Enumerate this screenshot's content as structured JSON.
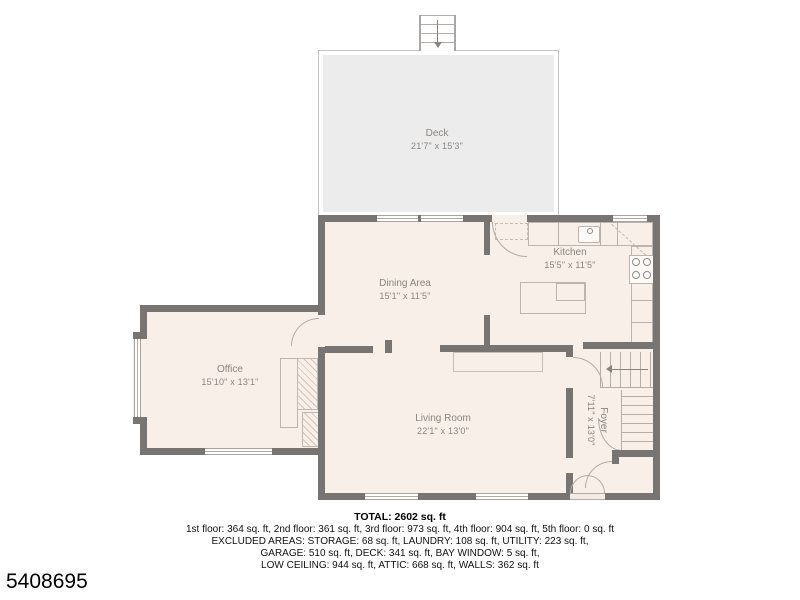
{
  "plan": {
    "watermark_id": "5408695",
    "rooms": {
      "deck": {
        "label": "Deck",
        "dims": "21'7\" x 15'3\""
      },
      "dining": {
        "label": "Dining Area",
        "dims": "15'1\" x 11'5\""
      },
      "kitchen": {
        "label": "Kitchen",
        "dims": "15'5\" x 11'5\""
      },
      "office": {
        "label": "Office",
        "dims": "15'10\" x 13'1\""
      },
      "living": {
        "label": "Living Room",
        "dims": "22'1\" x 13'0\""
      },
      "foyer": {
        "label": "Foyer",
        "dims": "7'11\" x 13'0\""
      }
    },
    "summary": {
      "total": "TOTAL: 2602 sq. ft",
      "line1": "1st floor: 364 sq. ft, 2nd floor: 361 sq. ft, 3rd floor: 973 sq. ft, 4th floor: 904 sq. ft, 5th floor: 0 sq. ft",
      "line2": "EXCLUDED AREAS: STORAGE: 68 sq. ft, LAUNDRY: 108 sq. ft, UTILITY: 223 sq. ft,",
      "line3": "GARAGE: 510 sq. ft, DECK: 341 sq. ft, BAY WINDOW: 5 sq. ft,",
      "line4": "LOW CEILING: 944 sq. ft, ATTIC: 668 sq. ft, WALLS: 362 sq. ft"
    },
    "colors": {
      "wall": "#787472",
      "floor": "#f7efe8",
      "deck_fill": "#ececec",
      "fixture_line": "#b8b1ab",
      "label_text": "#8b8581"
    }
  }
}
